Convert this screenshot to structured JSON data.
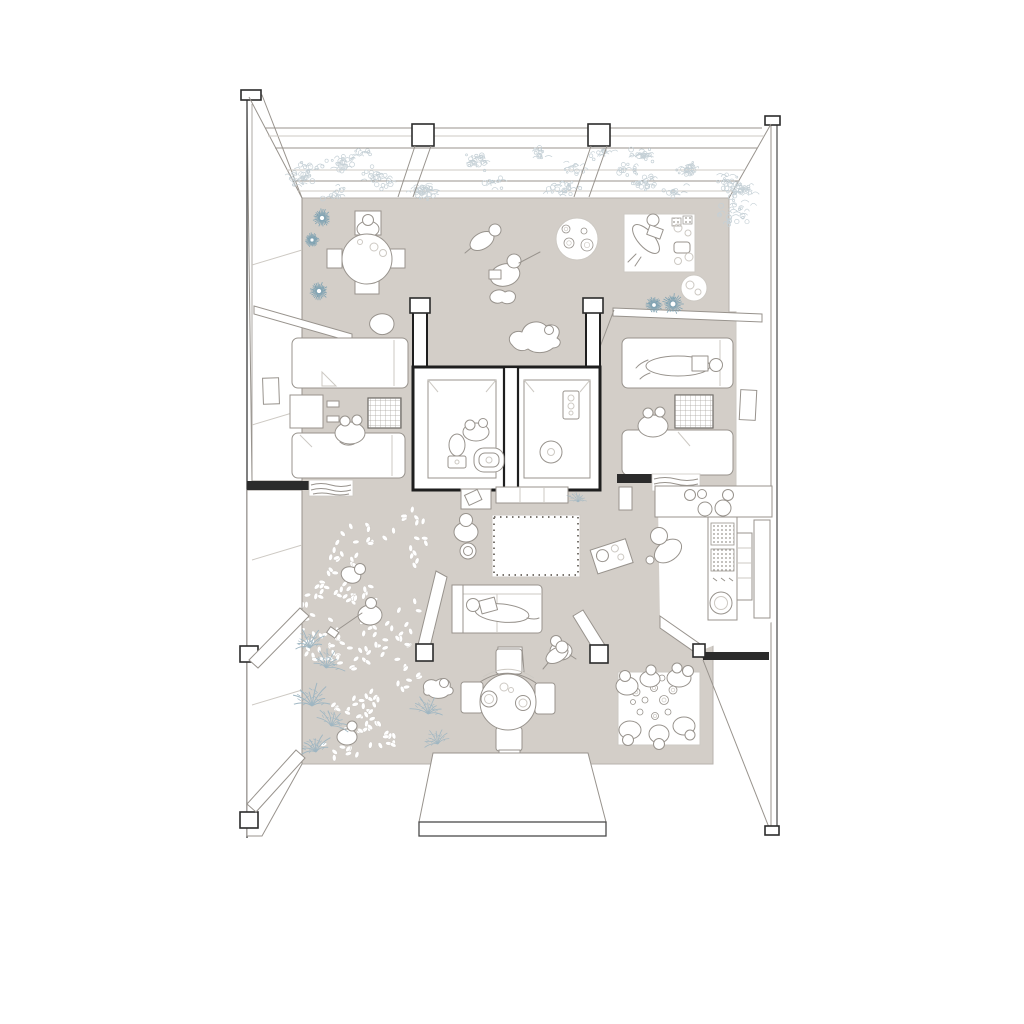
{
  "meta": {
    "kind": "architectural axonometric floor plan illustration",
    "visible_text": "none",
    "canvas": {
      "width": 1024,
      "height": 1024
    }
  },
  "palette": {
    "bg": "#ffffff",
    "floor": "#d3cec8",
    "floor_edge": "#b7b2ac",
    "line": "#98938d",
    "line_light": "#cdc9c3",
    "dark": "#2b2b2b",
    "core_wall": "#1e1e1e",
    "leaf": "#ffffff",
    "leaf_edge": "#c6c1bb",
    "fern": "#9fb6c2",
    "starburst": "#7fa2b2",
    "foliage": "#c5d0d6",
    "hatch": "#8f8a84"
  },
  "generated": {
    "leaves": {
      "seed": 11,
      "clusters": 24,
      "per_cluster": 8,
      "area": {
        "x": 306,
        "y": 498,
        "w": 120,
        "h": 260
      },
      "rx": 3.3,
      "ry": 1.9
    },
    "foliage": {
      "seed": 5,
      "clusters": 30,
      "band": {
        "x": 272,
        "y": 151,
        "w": 480,
        "h": 42
      },
      "extra": [
        {
          "x": 733,
          "y": 212,
          "r": 26
        },
        {
          "x": 300,
          "y": 178,
          "r": 16
        }
      ]
    },
    "starbursts": [
      {
        "x": 322,
        "y": 218,
        "r": 9
      },
      {
        "x": 312,
        "y": 240,
        "r": 7
      },
      {
        "x": 319,
        "y": 291,
        "r": 9
      },
      {
        "x": 654,
        "y": 305,
        "r": 8
      },
      {
        "x": 673,
        "y": 304,
        "r": 10
      }
    ],
    "ferns": [
      {
        "x": 310,
        "y": 648,
        "s": 1.0,
        "rot": -10
      },
      {
        "x": 326,
        "y": 668,
        "s": 0.9,
        "rot": 15
      },
      {
        "x": 312,
        "y": 706,
        "s": 1.1,
        "rot": 0
      },
      {
        "x": 331,
        "y": 726,
        "s": 0.9,
        "rot": 25
      },
      {
        "x": 316,
        "y": 752,
        "s": 1.0,
        "rot": -15
      },
      {
        "x": 428,
        "y": 714,
        "s": 0.9,
        "rot": 10
      },
      {
        "x": 438,
        "y": 744,
        "s": 0.8,
        "rot": -20
      },
      {
        "x": 578,
        "y": 502,
        "s": 0.6,
        "rot": 0
      }
    ],
    "round_rug_toys": [
      {
        "x": 566,
        "y": 229,
        "r": 4
      },
      {
        "x": 569,
        "y": 243,
        "r": 5
      },
      {
        "x": 584,
        "y": 231,
        "r": 3
      },
      {
        "x": 587,
        "y": 245,
        "r": 6
      }
    ],
    "toy_mat_toys": [
      {
        "x": 636,
        "y": 692,
        "r": 4
      },
      {
        "x": 645,
        "y": 700,
        "r": 3
      },
      {
        "x": 654,
        "y": 688,
        "r": 3.5
      },
      {
        "x": 664,
        "y": 700,
        "r": 4.5
      },
      {
        "x": 640,
        "y": 712,
        "r": 3
      },
      {
        "x": 655,
        "y": 716,
        "r": 3.5
      },
      {
        "x": 668,
        "y": 712,
        "r": 3
      },
      {
        "x": 633,
        "y": 702,
        "r": 2.5
      },
      {
        "x": 673,
        "y": 690,
        "r": 4
      },
      {
        "x": 662,
        "y": 678,
        "r": 3
      }
    ]
  },
  "scene": {
    "balcony": {
      "items": [
        "planter-garden",
        "column",
        "column"
      ]
    },
    "living_hall_top": {
      "items": [
        "round-table",
        "chairs",
        "seated-person",
        "crawling-child",
        "sitting-child",
        "round-play-rug",
        "reading-mat",
        "small-round-rug",
        "dog",
        "cat"
      ]
    },
    "left_bedroom": {
      "items": [
        "bed",
        "bed",
        "desk",
        "hatched-rug",
        "two-children",
        "wall-art",
        "blanket-pouf"
      ]
    },
    "right_bedroom": {
      "items": [
        "bed-with-person",
        "bed",
        "hatched-rug",
        "two-children",
        "mirror"
      ]
    },
    "bathroom_core": {
      "items": [
        "toilet",
        "basin",
        "person",
        "shower-drain",
        "shower-panel"
      ]
    },
    "kitchen": {
      "items": [
        "counter",
        "sink",
        "burners",
        "pantry-baskets",
        "washing-machine",
        "shelf",
        "kneeling-person"
      ]
    },
    "living_room": {
      "items": [
        "sideboard",
        "laptop-table",
        "plant",
        "fringed-rug",
        "standing-person",
        "sofa-with-person",
        "bench",
        "bench",
        "stool",
        "crouching-child",
        "tea-tray"
      ]
    },
    "leaf_play_area": {
      "items": [
        "scattered-leaves",
        "curled-child",
        "sweeping-child",
        "crouching-child",
        "ferns"
      ]
    },
    "dining": {
      "items": [
        "round-table",
        "plates",
        "chair",
        "chair",
        "chair",
        "chair",
        "walking-person",
        "cat"
      ]
    },
    "toy_corner": {
      "items": [
        "play-mat",
        "six-children",
        "toys"
      ]
    },
    "entry_platform": {
      "items": [
        "ramp-platform"
      ]
    }
  }
}
